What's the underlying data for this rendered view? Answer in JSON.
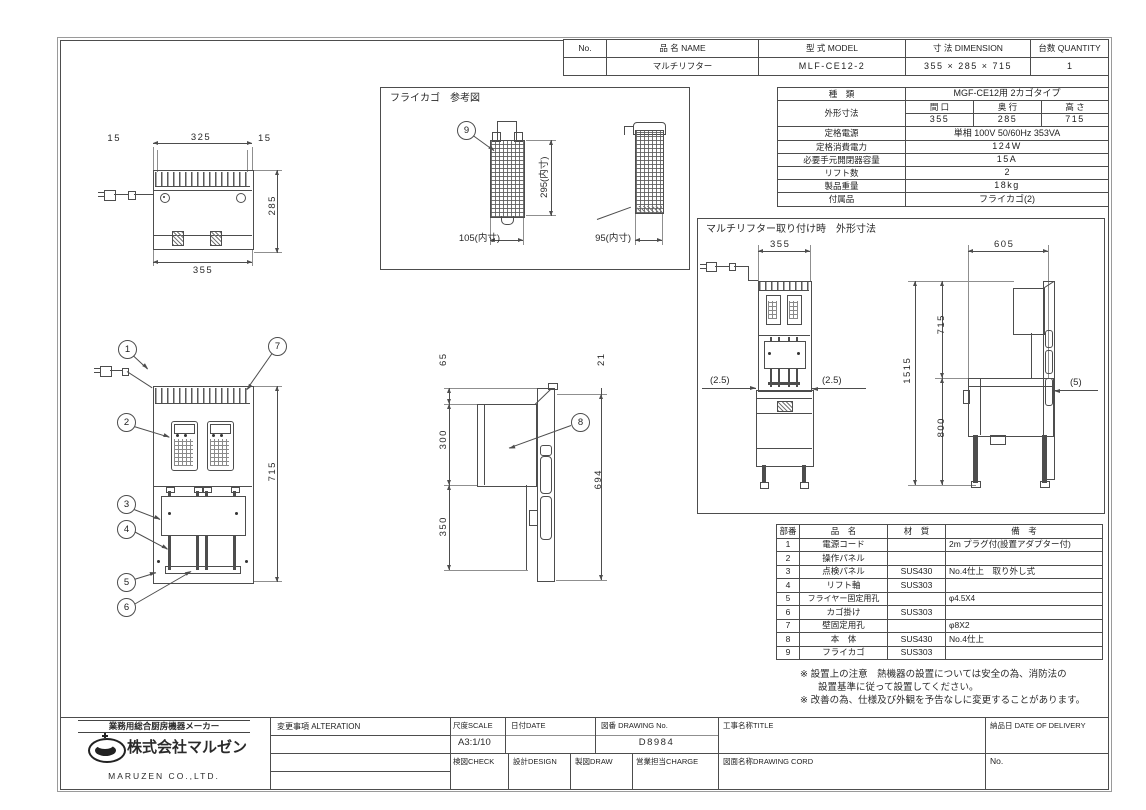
{
  "colors": {
    "line": "#4d4d4d",
    "text": "#222222",
    "bg": "#ffffff"
  },
  "header": {
    "no_label": "No.",
    "name_label": "品 名  NAME",
    "model_label": "型 式  MODEL",
    "dim_label": "寸 法  DIMENSION",
    "qty_label": "台数 QUANTITY",
    "name": "マルチリフター",
    "model": "MLF-CE12-2",
    "dimension": "355 × 285 × 715",
    "qty": "1"
  },
  "spec": {
    "kind_label": "種　類",
    "kind": "MGF-CE12用 2カゴタイプ",
    "outer_label": "外形寸法",
    "w_label": "間 口",
    "d_label": "奥 行",
    "h_label": "高 さ",
    "w": "355",
    "d": "285",
    "h": "715",
    "power_label": "定格電源",
    "power": "単相 100V 50/60Hz 353VA",
    "consumption_label": "定格消費電力",
    "consumption": "124W",
    "breaker_label": "必要手元開閉器容量",
    "breaker": "15A",
    "lift_label": "リフト数",
    "lift": "2",
    "weight_label": "製品重量",
    "weight": "18kg",
    "accessory_label": "付属品",
    "accessory": "フライカゴ(2)"
  },
  "basket": {
    "title": "フライカゴ　参考図",
    "callout": "9",
    "dim_height": "295(内寸)",
    "dim_width": "105(内寸)",
    "dim_depth": "95(内寸)"
  },
  "install": {
    "title": "マルチリフター取り付け時　外形寸法",
    "front_width": "355",
    "gap_left": "(2.5)",
    "gap_right": "(2.5)",
    "side_depth": "605",
    "upper_height": "715",
    "total_height": "1515",
    "lower_height": "800",
    "wall_gap": "(5)"
  },
  "plan": {
    "dim_left": "15",
    "dim_center": "325",
    "dim_right": "15",
    "dim_depth": "285",
    "dim_width": "355"
  },
  "front": {
    "dim_height": "715",
    "c1": "1",
    "c2": "2",
    "c3": "3",
    "c4": "4",
    "c5": "5",
    "c6": "6",
    "c7": "7"
  },
  "side": {
    "dim_top": "65",
    "dim_mid": "300",
    "dim_bottom": "350",
    "dim_back": "21",
    "dim_total": "694",
    "c8": "8"
  },
  "parts": {
    "no_label": "部番",
    "name_label": "品　名",
    "material_label": "材　質",
    "remarks_label": "備　考",
    "rows": [
      {
        "no": "1",
        "name": "電源コード",
        "material": "",
        "remarks": "2m プラグ付(設置アダプター付)"
      },
      {
        "no": "2",
        "name": "操作パネル",
        "material": "",
        "remarks": ""
      },
      {
        "no": "3",
        "name": "点検パネル",
        "material": "SUS430",
        "remarks": "No.4仕上　取り外し式"
      },
      {
        "no": "4",
        "name": "リフト軸",
        "material": "SUS303",
        "remarks": ""
      },
      {
        "no": "5",
        "name": "フライヤー固定用孔",
        "material": "",
        "remarks": "φ4.5X4"
      },
      {
        "no": "6",
        "name": "カゴ掛け",
        "material": "SUS303",
        "remarks": ""
      },
      {
        "no": "7",
        "name": "壁固定用孔",
        "material": "",
        "remarks": "φ8X2"
      },
      {
        "no": "8",
        "name": "本　体",
        "material": "SUS430",
        "remarks": "No.4仕上"
      },
      {
        "no": "9",
        "name": "フライカゴ",
        "material": "SUS303",
        "remarks": ""
      }
    ]
  },
  "notes": {
    "line1": "※ 設置上の注意　熱機器の設置については安全の為、消防法の",
    "line2": "設置基準に従って設置してください。",
    "line3": "※ 改善の為、仕様及び外観を予告なしに変更することがあります。"
  },
  "titleblock": {
    "tagline": "業務用総合厨房機器メーカー",
    "company": "株式会社マルゼン",
    "company_en": "MARUZEN CO.,LTD.",
    "alteration_label": "変更事項  ALTERATION",
    "scale_label": "尺度SCALE",
    "scale": "A3:1/10",
    "date_label": "日付DATE",
    "drawing_no_label": "図番 DRAWING No.",
    "drawing_no": "D8984",
    "title_label": "工事名称TITLE",
    "delivery_label": "納品日  DATE OF DELIVERY",
    "check_label": "検図CHECK",
    "design_label": "設計DESIGN",
    "draw_label": "製図DRAW",
    "charge_label": "営業担当CHARGE",
    "drawing_name_label": "図面名称DRAWING CORD",
    "no_label": "No."
  }
}
